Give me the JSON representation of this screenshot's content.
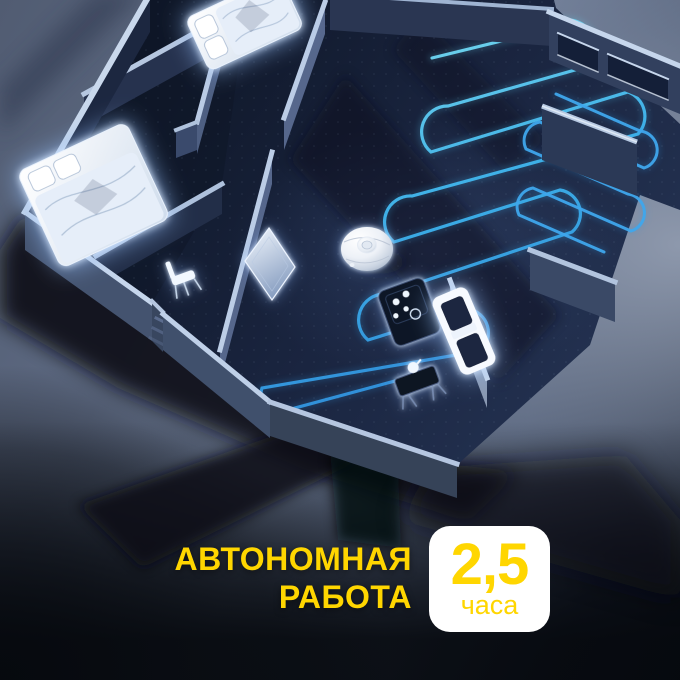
{
  "scene": {
    "description": "Night-style 3D isometric apartment cutaway with a white robot vacuum following a blue serpentine cleaning route",
    "colors": {
      "route_start": "#7FE3F5",
      "route_mid": "#3EB5EE",
      "route_end": "#2B84D8",
      "floor_dark": "#111A2D",
      "wall_top_light": "#C3D3E8",
      "furniture_glow": "#D8EAFF",
      "background_light": "#8C97AC",
      "background_dark": "#0A0E15"
    },
    "objects": [
      {
        "name": "robot-vacuum"
      },
      {
        "name": "cleaning-route"
      },
      {
        "name": "bed-top-bedroom"
      },
      {
        "name": "bed-left-bedroom"
      },
      {
        "name": "hallway-chair"
      },
      {
        "name": "doormat"
      },
      {
        "name": "stove"
      },
      {
        "name": "kitchen-cabinet"
      },
      {
        "name": "side-table"
      },
      {
        "name": "windows"
      },
      {
        "name": "counter-block"
      }
    ]
  },
  "caption": {
    "line1": "АВТОНОМНАЯ",
    "line2": "РАБОТА",
    "color": "#FFD600"
  },
  "badge": {
    "value": "2,5",
    "unit": "часа",
    "background": "#FFFFFF",
    "color": "#FFD600"
  }
}
